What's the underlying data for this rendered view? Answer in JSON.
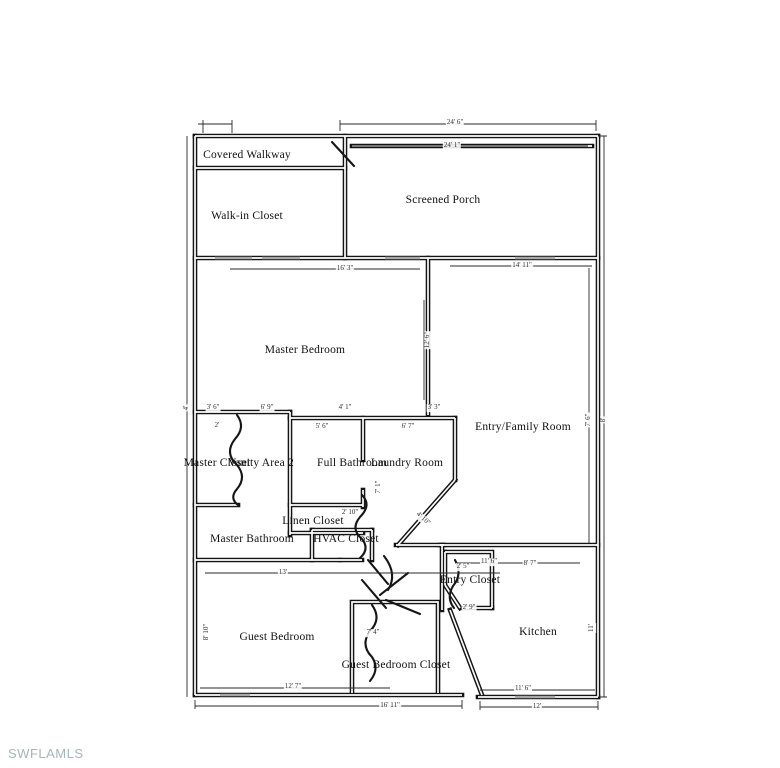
{
  "watermark": {
    "text": "SWFLAMLS"
  },
  "floorplan": {
    "rooms": [
      {
        "label": "Covered Walkway",
        "x": 247,
        "y": 155
      },
      {
        "label": "Walk-in Closet",
        "x": 247,
        "y": 216
      },
      {
        "label": "Screened Porch",
        "x": 443,
        "y": 200
      },
      {
        "label": "Master Bedroom",
        "x": 305,
        "y": 350
      },
      {
        "label": "Entry/Family Room",
        "x": 523,
        "y": 427
      },
      {
        "label": "Master Closet",
        "x": 217,
        "y": 463
      },
      {
        "label": "Vanity Area 2",
        "x": 261,
        "y": 463
      },
      {
        "label": "Full Bathroom",
        "x": 352,
        "y": 463
      },
      {
        "label": "Laundry Room",
        "x": 407,
        "y": 463
      },
      {
        "label": "Linen Closet",
        "x": 313,
        "y": 521
      },
      {
        "label": "Master Bathroom",
        "x": 252,
        "y": 539
      },
      {
        "label": "HVAC Closet",
        "x": 346,
        "y": 539
      },
      {
        "label": "Entry Closet",
        "x": 470,
        "y": 580
      },
      {
        "label": "Guest Bedroom",
        "x": 277,
        "y": 637
      },
      {
        "label": "Guest Bedroom Closet",
        "x": 396,
        "y": 665
      },
      {
        "label": "Kitchen",
        "x": 538,
        "y": 632
      }
    ],
    "dimensions": [
      {
        "text": "24' 6\"",
        "x": 455,
        "y": 123,
        "rot": 0
      },
      {
        "text": "24' 1\"",
        "x": 452,
        "y": 146,
        "rot": 0
      },
      {
        "text": "16' 3\"",
        "x": 345,
        "y": 269,
        "rot": 0
      },
      {
        "text": "14' 11\"",
        "x": 522,
        "y": 266,
        "rot": 0
      },
      {
        "text": "12' 6\"",
        "x": 428,
        "y": 340,
        "rot": 90
      },
      {
        "text": "7' 6\"",
        "x": 589,
        "y": 420,
        "rot": 90
      },
      {
        "text": "8'",
        "x": 604,
        "y": 420,
        "rot": 90
      },
      {
        "text": "4'",
        "x": 187,
        "y": 408,
        "rot": 90
      },
      {
        "text": "3' 6\"",
        "x": 213,
        "y": 408,
        "rot": 0
      },
      {
        "text": "6' 9\"",
        "x": 267,
        "y": 408,
        "rot": 0
      },
      {
        "text": "4' 1\"",
        "x": 345,
        "y": 408,
        "rot": 0
      },
      {
        "text": "3' 3\"",
        "x": 434,
        "y": 408,
        "rot": 0
      },
      {
        "text": "2'",
        "x": 217,
        "y": 426,
        "rot": 0
      },
      {
        "text": "5' 6\"",
        "x": 322,
        "y": 427,
        "rot": 0
      },
      {
        "text": "6' 7\"",
        "x": 408,
        "y": 427,
        "rot": 0
      },
      {
        "text": "7' 1\"",
        "x": 379,
        "y": 487,
        "rot": 90
      },
      {
        "text": "2' 10\"",
        "x": 350,
        "y": 513,
        "rot": 0
      },
      {
        "text": "4' 10\"",
        "x": 423,
        "y": 519,
        "rot": 42
      },
      {
        "text": "13'",
        "x": 283,
        "y": 573,
        "rot": 0
      },
      {
        "text": "8' 10\"",
        "x": 207,
        "y": 632,
        "rot": 90
      },
      {
        "text": "7' 4\"",
        "x": 373,
        "y": 633,
        "rot": 0
      },
      {
        "text": "12' 7\"",
        "x": 293,
        "y": 687,
        "rot": 0
      },
      {
        "text": "16' 11\"",
        "x": 390,
        "y": 706,
        "rot": 0
      },
      {
        "text": "11' 6\"",
        "x": 523,
        "y": 689,
        "rot": 0
      },
      {
        "text": "12'",
        "x": 537,
        "y": 707,
        "rot": 0
      },
      {
        "text": "11' 6\"",
        "x": 489,
        "y": 562,
        "rot": 0
      },
      {
        "text": "8' 7\"",
        "x": 530,
        "y": 564,
        "rot": 0
      },
      {
        "text": "2' 5\"",
        "x": 463,
        "y": 567,
        "rot": 0
      },
      {
        "text": "2' 9\"",
        "x": 469,
        "y": 608,
        "rot": 0
      },
      {
        "text": "11'",
        "x": 592,
        "y": 628,
        "rot": 90
      }
    ]
  }
}
